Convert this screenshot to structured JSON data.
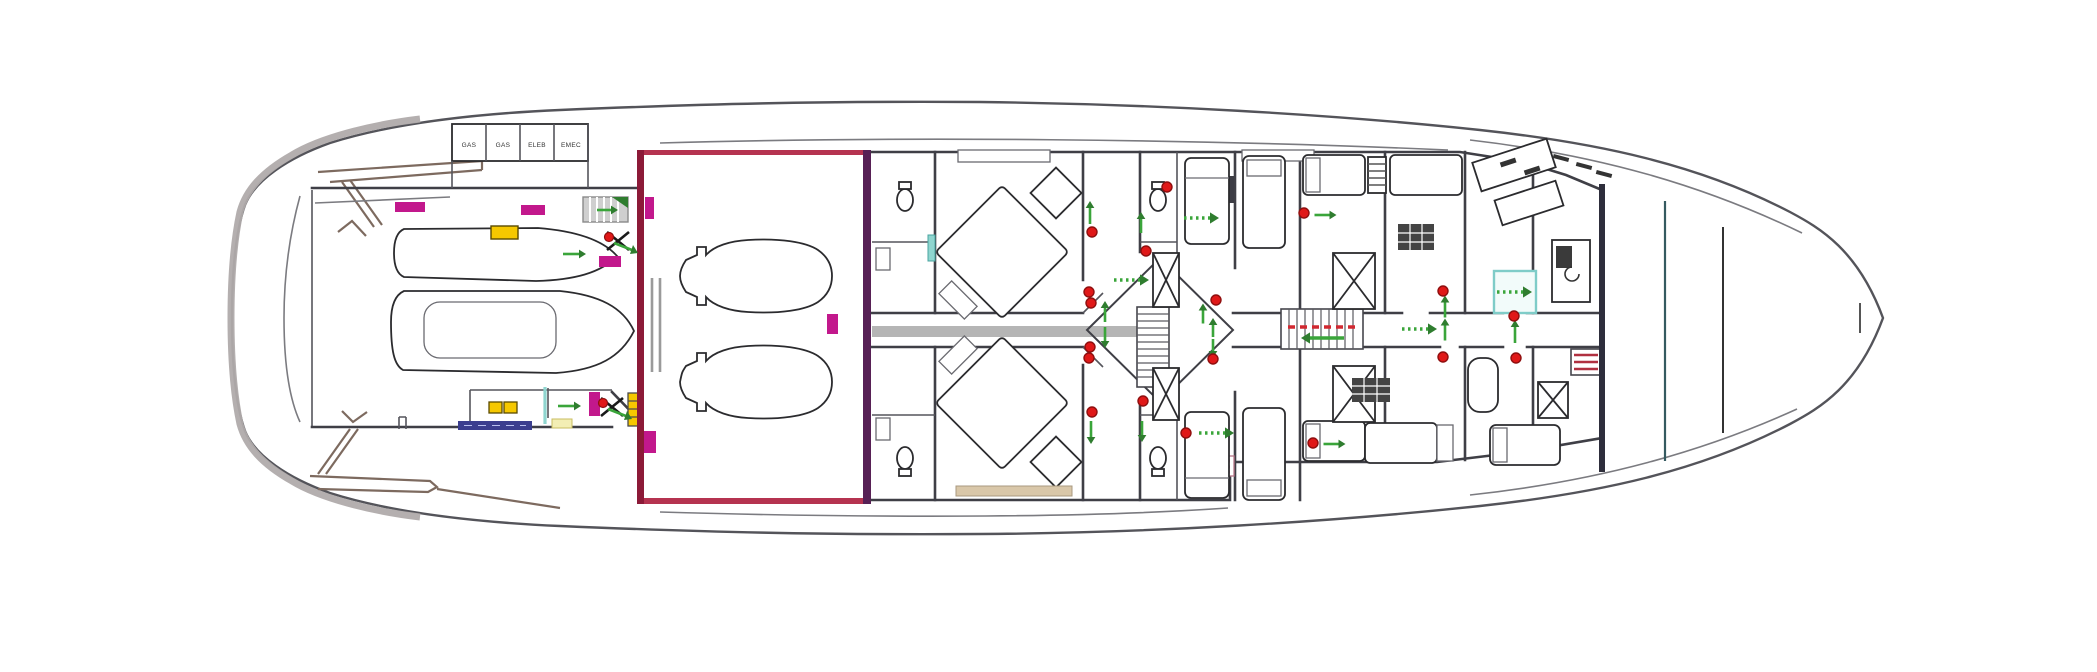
{
  "plan": {
    "name": "yacht-lower-deck-floor-plan",
    "garage_lockers": {
      "labels": [
        "GAS",
        "GAS",
        "ELEB",
        "EMEC"
      ]
    }
  },
  "colors": {
    "magenta": "#c2188c",
    "yellow": "#f6c800",
    "pale_yellow": "#f3eeb4",
    "red": "#e01818",
    "red_dark": "#8f0f0f",
    "green": "#3aa53a",
    "green_dark": "#2f7d2f",
    "teal": "#8fd5cf",
    "maroon_border": "#8c1a38",
    "purple_border": "#572055",
    "crimson_border": "#b53350",
    "corridor_gray": "#b5b5b5",
    "escape_red": "#d12830",
    "passarelle_blue": "#3b3e8f"
  },
  "markers": {
    "red_dots": [
      [
        1089,
        292
      ],
      [
        1091,
        303
      ],
      [
        1090,
        347
      ],
      [
        1089,
        358
      ],
      [
        1092,
        232
      ],
      [
        1092,
        412
      ],
      [
        1216,
        300
      ],
      [
        1213,
        359
      ],
      [
        1167,
        187
      ],
      [
        1146,
        251
      ],
      [
        1143,
        401
      ],
      [
        1186,
        433
      ],
      [
        1304,
        213
      ],
      [
        1313,
        443
      ],
      [
        1443,
        291
      ],
      [
        1443,
        357
      ],
      [
        1514,
        316
      ],
      [
        1516,
        358
      ]
    ],
    "green_arrows": [
      [
        571,
        254,
        "right",
        16
      ],
      [
        566,
        406,
        "right",
        16
      ],
      [
        604,
        210,
        "right",
        14
      ],
      [
        1090,
        216,
        "up",
        16
      ],
      [
        1091,
        429,
        "down",
        16
      ],
      [
        1141,
        226,
        "up",
        14
      ],
      [
        1142,
        428,
        "down",
        14
      ],
      [
        1105,
        315,
        "up",
        14
      ],
      [
        1105,
        334,
        "down",
        14
      ],
      [
        1203,
        317,
        "up",
        13
      ],
      [
        1213,
        331,
        "up",
        12
      ],
      [
        1213,
        345,
        "down",
        12
      ],
      [
        1322,
        215,
        "right",
        15
      ],
      [
        1331,
        444,
        "right",
        15
      ],
      [
        1445,
        310,
        "up",
        15
      ],
      [
        1445,
        333,
        "up",
        15
      ],
      [
        1515,
        335,
        "up",
        16
      ],
      [
        1327,
        338,
        "left",
        34
      ]
    ],
    "dotted_arrows": [
      [
        1114,
        280
      ],
      [
        1184,
        218
      ],
      [
        1199,
        433
      ],
      [
        1402,
        329
      ],
      [
        1497,
        292
      ]
    ],
    "muster_points": [
      [
        618,
        241
      ],
      [
        612,
        407
      ]
    ],
    "magenta_rects": [
      [
        395,
        202,
        30,
        10
      ],
      [
        521,
        205,
        24,
        10
      ],
      [
        599,
        256,
        22,
        11
      ],
      [
        645,
        197,
        9,
        22
      ],
      [
        644,
        431,
        12,
        22
      ],
      [
        827,
        314,
        11,
        20
      ],
      [
        589,
        392,
        11,
        24
      ]
    ],
    "yellow_rects": [
      [
        491,
        226,
        27,
        13
      ]
    ],
    "yellow_squares": [
      [
        489,
        402,
        13,
        11
      ],
      [
        504,
        402,
        13,
        11
      ]
    ],
    "pale_yellow_rects": [
      [
        552,
        419,
        20,
        9
      ]
    ],
    "teal_door_lines": [
      [
        545,
        387,
        545,
        424
      ]
    ],
    "teal_strips": [
      [
        928,
        235,
        7,
        26
      ]
    ],
    "teal_boxes": [
      [
        1494,
        271,
        42,
        42
      ]
    ],
    "escape_dashes": {
      "x1": 1288,
      "y": 327,
      "x2": 1356
    }
  }
}
